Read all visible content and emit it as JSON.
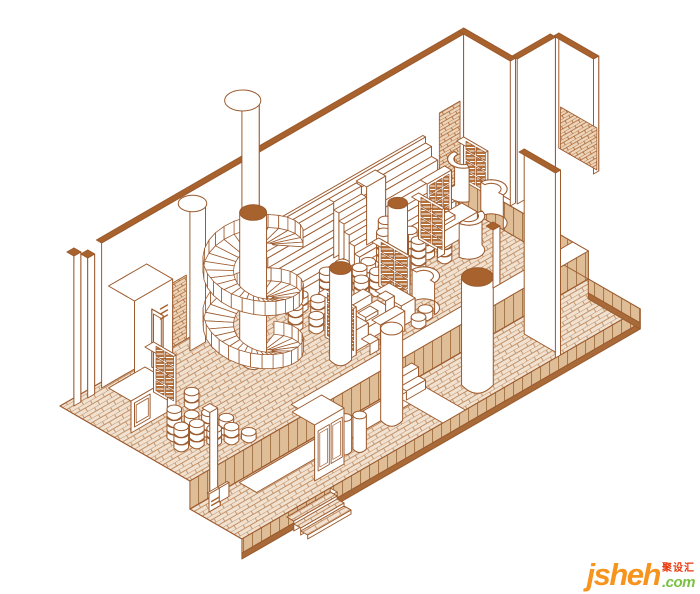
{
  "page": {
    "background": "#ffffff"
  },
  "illustration": {
    "label": "axonometric-interior-line-drawing",
    "colors": {
      "line": "#9c5a2d",
      "cap": "#a8622d",
      "white": "#ffffff",
      "floor_bg": "#f0e1d0",
      "floor_line": "#c29167",
      "side_bg": "#dfbd97",
      "side_line": "#a87a4b",
      "base": "#a86a38",
      "cell": "#b4713c",
      "wall_patch_bg": "#ecd5bb",
      "path": "#ffffff"
    }
  },
  "watermark": {
    "brand": "jsheh",
    "cjk": "聚设汇",
    "tld": ".com",
    "brand_color": "#f7941e",
    "cjk_color": "#e8380d",
    "tld_color": "#7ac143"
  }
}
